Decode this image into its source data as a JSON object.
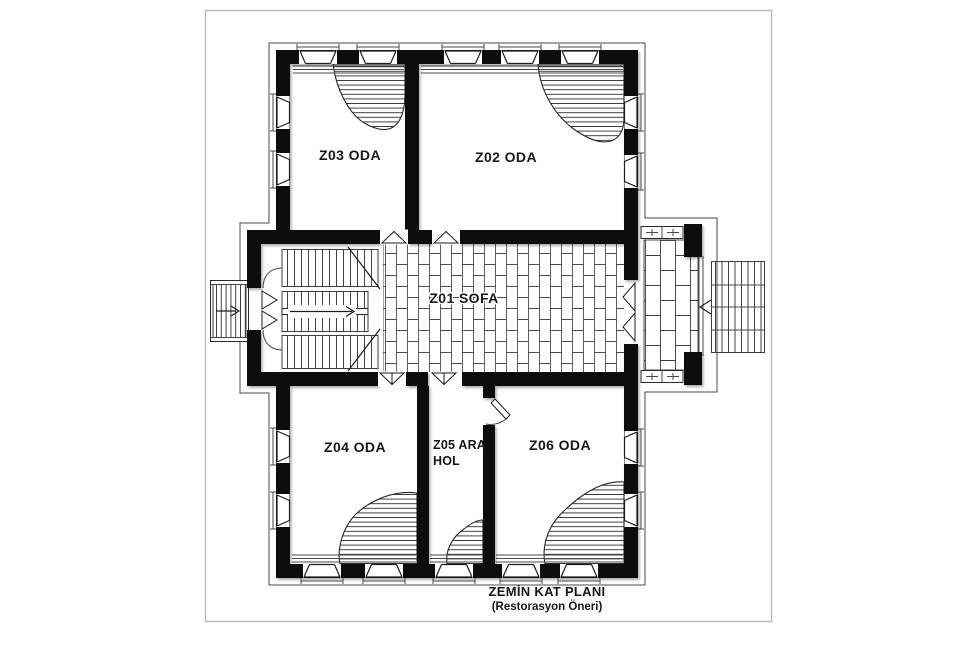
{
  "sheet": {
    "caption_line1": "ZEMİN KAT PLANI",
    "caption_line2": "(Restorasyon Öneri)"
  },
  "rooms": {
    "z01": {
      "label": "Z01 SOFA"
    },
    "z02": {
      "label": "Z02 ODA"
    },
    "z03": {
      "label": "Z03 ODA"
    },
    "z04": {
      "label": "Z04 ODA"
    },
    "z05": {
      "label_line1": "Z05 ARA",
      "label_line2": "HOL"
    },
    "z06": {
      "label": "Z06 ODA"
    }
  },
  "icons": {
    "interior_stair_arrow": "right-arrow",
    "left_exterior_stair_arrow": "right-arrow",
    "right_exterior_stair_arrow": "left-arrow"
  },
  "colors": {
    "wall": "#101010",
    "line": "#4a4a4a",
    "frame": "#b9b9b9",
    "paper": "#ffffff",
    "text": "#161616"
  }
}
